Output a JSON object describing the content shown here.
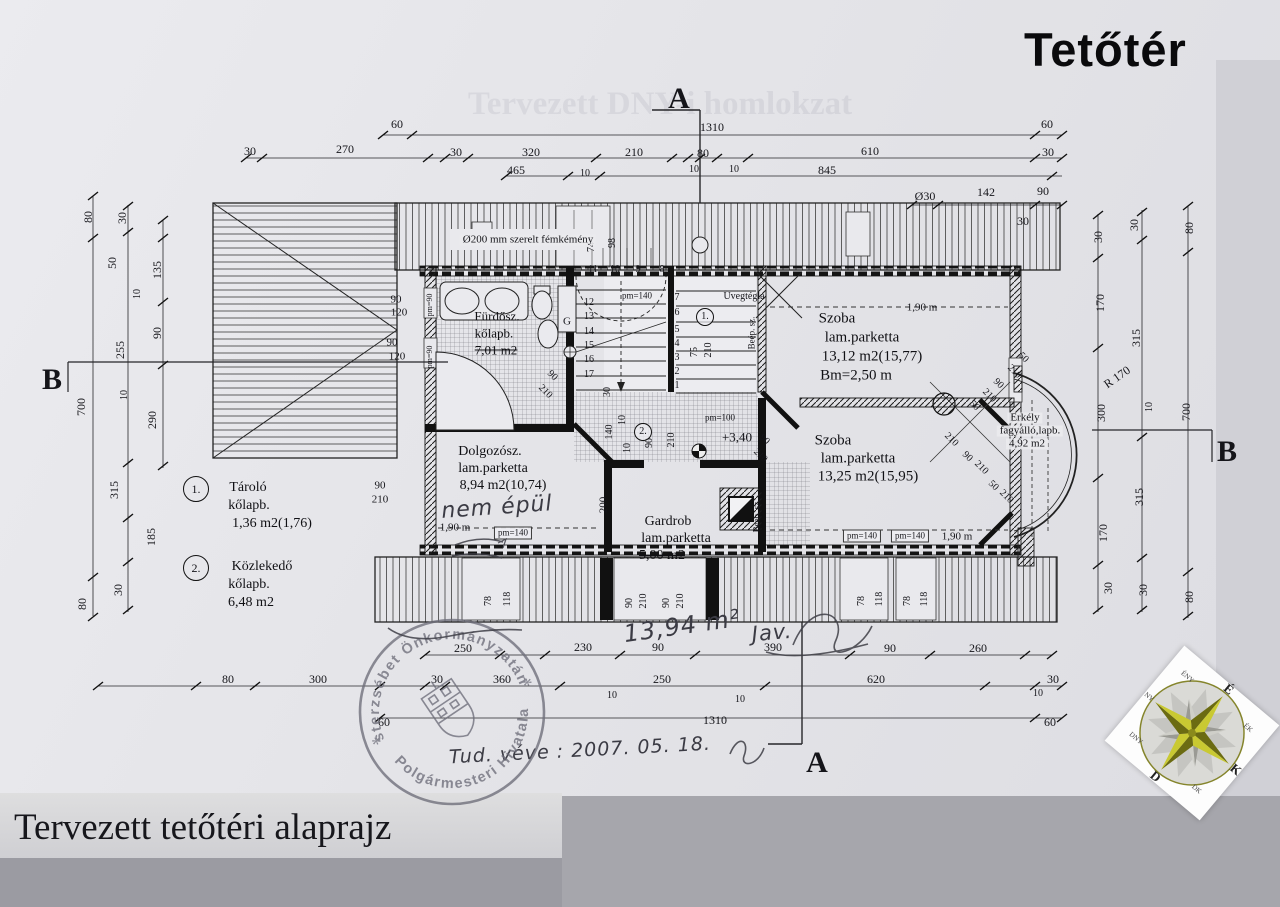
{
  "page": {
    "title": "Tetőtér",
    "caption": "Tervezett tetőtéri alaprajz",
    "ghost_text": "Tervezett DNY-i homlokzat"
  },
  "stamp": {
    "arc_top": "Pesterzsébet Önkormányzatának",
    "arc_bottom": "Polgármesteri Hivatala",
    "star": "*",
    "ink_color": "#6e6e7a"
  },
  "compass": {
    "points": [
      {
        "t": "É",
        "a": 0
      },
      {
        "t": "ÉK",
        "a": 45
      },
      {
        "t": "K",
        "a": 90
      },
      {
        "t": "DK",
        "a": 135
      },
      {
        "t": "D",
        "a": 180
      },
      {
        "t": "DNY",
        "a": 225
      },
      {
        "t": "NY",
        "a": 270
      },
      {
        "t": "ÉNY",
        "a": 315
      }
    ],
    "star_color": "#a8a81e"
  },
  "plan": {
    "labels": [
      {
        "t": "60",
        "x": 397,
        "y": 124
      },
      {
        "t": "1310",
        "x": 712,
        "y": 127
      },
      {
        "t": "60",
        "x": 1047,
        "y": 124
      },
      {
        "t": "30",
        "x": 250,
        "y": 151
      },
      {
        "t": "270",
        "x": 345,
        "y": 149
      },
      {
        "t": "30",
        "x": 456,
        "y": 152
      },
      {
        "t": "320",
        "x": 531,
        "y": 152
      },
      {
        "t": "210",
        "x": 634,
        "y": 152
      },
      {
        "t": "80",
        "x": 703,
        "y": 153
      },
      {
        "t": "610",
        "x": 870,
        "y": 151
      },
      {
        "t": "30",
        "x": 1048,
        "y": 152
      },
      {
        "t": "10",
        "x": 694,
        "y": 170,
        "s": 10
      },
      {
        "t": "10",
        "x": 734,
        "y": 170,
        "s": 10
      },
      {
        "t": "465",
        "x": 516,
        "y": 170
      },
      {
        "t": "10",
        "x": 585,
        "y": 174,
        "s": 10
      },
      {
        "t": "845",
        "x": 827,
        "y": 170
      },
      {
        "t": "Ø30",
        "x": 925,
        "y": 196
      },
      {
        "t": "142",
        "x": 986,
        "y": 192
      },
      {
        "t": "90",
        "x": 1043,
        "y": 191
      },
      {
        "t": "30",
        "x": 1023,
        "y": 221
      },
      {
        "t": "30",
        "x": 1098,
        "y": 237,
        "r": -90
      },
      {
        "t": "30",
        "x": 1134,
        "y": 225,
        "r": -90
      },
      {
        "t": "80",
        "x": 1189,
        "y": 228,
        "r": -90
      },
      {
        "t": "170",
        "x": 1100,
        "y": 303,
        "r": -90
      },
      {
        "t": "315",
        "x": 1136,
        "y": 338,
        "r": -90
      },
      {
        "t": "R 170",
        "x": 1117,
        "y": 377,
        "r": -35
      },
      {
        "t": "300",
        "x": 1101,
        "y": 413,
        "r": -90
      },
      {
        "t": "10",
        "x": 1150,
        "y": 407,
        "r": -90,
        "s": 10
      },
      {
        "t": "700",
        "x": 1186,
        "y": 412,
        "r": -90
      },
      {
        "t": "315",
        "x": 1139,
        "y": 497,
        "r": -90
      },
      {
        "t": "170",
        "x": 1103,
        "y": 533,
        "r": -90
      },
      {
        "t": "30",
        "x": 1108,
        "y": 588,
        "r": -90
      },
      {
        "t": "30",
        "x": 1143,
        "y": 590,
        "r": -90
      },
      {
        "t": "80",
        "x": 1189,
        "y": 597,
        "r": -90
      },
      {
        "t": "80",
        "x": 88,
        "y": 217,
        "r": -90
      },
      {
        "t": "30",
        "x": 122,
        "y": 218,
        "r": -90
      },
      {
        "t": "50",
        "x": 112,
        "y": 263,
        "r": -90
      },
      {
        "t": "135",
        "x": 157,
        "y": 270,
        "r": -90
      },
      {
        "t": "10",
        "x": 138,
        "y": 294,
        "r": -90,
        "s": 10
      },
      {
        "t": "90",
        "x": 157,
        "y": 333,
        "r": -90
      },
      {
        "t": "255",
        "x": 120,
        "y": 350,
        "r": -90
      },
      {
        "t": "700",
        "x": 81,
        "y": 407,
        "r": -90
      },
      {
        "t": "10",
        "x": 125,
        "y": 395,
        "r": -90,
        "s": 10
      },
      {
        "t": "290",
        "x": 152,
        "y": 420,
        "r": -90
      },
      {
        "t": "315",
        "x": 114,
        "y": 490,
        "r": -90
      },
      {
        "t": "185",
        "x": 151,
        "y": 537,
        "r": -90
      },
      {
        "t": "30",
        "x": 118,
        "y": 590,
        "r": -90
      },
      {
        "t": "80",
        "x": 82,
        "y": 604,
        "r": -90
      },
      {
        "t": "250",
        "x": 463,
        "y": 648
      },
      {
        "t": "230",
        "x": 583,
        "y": 647
      },
      {
        "t": "90",
        "x": 658,
        "y": 647
      },
      {
        "t": "390",
        "x": 773,
        "y": 647
      },
      {
        "t": "90",
        "x": 890,
        "y": 648
      },
      {
        "t": "260",
        "x": 978,
        "y": 648
      },
      {
        "t": "80",
        "x": 228,
        "y": 679
      },
      {
        "t": "300",
        "x": 318,
        "y": 679
      },
      {
        "t": "30",
        "x": 437,
        "y": 679
      },
      {
        "t": "360",
        "x": 502,
        "y": 679
      },
      {
        "t": "10",
        "x": 612,
        "y": 696,
        "s": 10
      },
      {
        "t": "250",
        "x": 662,
        "y": 679
      },
      {
        "t": "620",
        "x": 876,
        "y": 679
      },
      {
        "t": "30",
        "x": 1053,
        "y": 679
      },
      {
        "t": "10",
        "x": 1038,
        "y": 694,
        "s": 10
      },
      {
        "t": "10",
        "x": 740,
        "y": 700,
        "s": 10
      },
      {
        "t": "1310",
        "x": 715,
        "y": 720
      },
      {
        "t": "60",
        "x": 1050,
        "y": 722
      },
      {
        "t": "60",
        "x": 384,
        "y": 722
      },
      {
        "t": "78",
        "x": 489,
        "y": 601,
        "r": -90,
        "s": 10
      },
      {
        "t": "118",
        "x": 508,
        "y": 599,
        "r": -90,
        "s": 10
      },
      {
        "t": "90",
        "x": 630,
        "y": 603,
        "r": -90,
        "s": 10
      },
      {
        "t": "210",
        "x": 644,
        "y": 601,
        "r": -90,
        "s": 10
      },
      {
        "t": "90",
        "x": 667,
        "y": 603,
        "r": -90,
        "s": 10
      },
      {
        "t": "210",
        "x": 681,
        "y": 601,
        "r": -90,
        "s": 10
      },
      {
        "t": "78",
        "x": 862,
        "y": 601,
        "r": -90,
        "s": 10
      },
      {
        "t": "118",
        "x": 880,
        "y": 599,
        "r": -90,
        "s": 10
      },
      {
        "t": "78",
        "x": 908,
        "y": 601,
        "r": -90,
        "s": 10
      },
      {
        "t": "118",
        "x": 925,
        "y": 599,
        "r": -90,
        "s": 10
      },
      {
        "t": "74",
        "x": 592,
        "y": 247,
        "r": -90,
        "s": 10
      },
      {
        "t": "98",
        "x": 613,
        "y": 243,
        "r": -90,
        "s": 10
      },
      {
        "t": "75",
        "x": 695,
        "y": 352,
        "r": -90,
        "s": 10
      },
      {
        "t": "210",
        "x": 709,
        "y": 350,
        "r": -90,
        "s": 10
      },
      {
        "t": "90",
        "x": 396,
        "y": 300,
        "s": 11
      },
      {
        "t": "120",
        "x": 399,
        "y": 313,
        "s": 11
      },
      {
        "t": "90",
        "x": 392,
        "y": 343,
        "s": 11
      },
      {
        "t": "120",
        "x": 397,
        "y": 357,
        "s": 11
      },
      {
        "t": "pm=90",
        "x": 430,
        "y": 305,
        "r": -90,
        "s": 8
      },
      {
        "t": "pm=90",
        "x": 430,
        "y": 357,
        "r": -90,
        "s": 8
      },
      {
        "t": "90",
        "x": 380,
        "y": 486,
        "s": 11
      },
      {
        "t": "210",
        "x": 380,
        "y": 500,
        "s": 11
      },
      {
        "t": "90",
        "x": 552,
        "y": 376,
        "r": 45,
        "s": 10
      },
      {
        "t": "210",
        "x": 545,
        "y": 392,
        "r": 45,
        "s": 10
      },
      {
        "t": "50",
        "x": 1023,
        "y": 358,
        "r": 45,
        "s": 10
      },
      {
        "t": "210",
        "x": 1014,
        "y": 372,
        "r": 45,
        "s": 10
      },
      {
        "t": "90",
        "x": 998,
        "y": 384,
        "r": 45,
        "s": 10
      },
      {
        "t": "210",
        "x": 989,
        "y": 396,
        "r": 45,
        "s": 10
      },
      {
        "t": "50",
        "x": 974,
        "y": 406,
        "r": 45,
        "s": 10
      },
      {
        "t": "210",
        "x": 951,
        "y": 440,
        "r": 45,
        "s": 10
      },
      {
        "t": "90",
        "x": 967,
        "y": 457,
        "r": 45,
        "s": 10
      },
      {
        "t": "210",
        "x": 981,
        "y": 468,
        "r": 45,
        "s": 10
      },
      {
        "t": "50",
        "x": 993,
        "y": 486,
        "r": 45,
        "s": 10
      },
      {
        "t": "210",
        "x": 1006,
        "y": 497,
        "r": 45,
        "s": 10
      },
      {
        "t": "90",
        "x": 764,
        "y": 440,
        "r": 45,
        "s": 10
      },
      {
        "t": "210",
        "x": 760,
        "y": 456,
        "r": 45,
        "s": 10
      },
      {
        "t": "12",
        "x": 589,
        "y": 303,
        "s": 10
      },
      {
        "t": "13",
        "x": 589,
        "y": 317,
        "s": 10
      },
      {
        "t": "14",
        "x": 589,
        "y": 332,
        "s": 10
      },
      {
        "t": "15",
        "x": 589,
        "y": 346,
        "s": 10
      },
      {
        "t": "16",
        "x": 589,
        "y": 360,
        "s": 10
      },
      {
        "t": "17",
        "x": 589,
        "y": 375,
        "s": 10
      },
      {
        "t": "7",
        "x": 677,
        "y": 298,
        "s": 10
      },
      {
        "t": "6",
        "x": 677,
        "y": 313,
        "s": 10
      },
      {
        "t": "5",
        "x": 677,
        "y": 330,
        "s": 10
      },
      {
        "t": "4",
        "x": 677,
        "y": 344,
        "s": 10
      },
      {
        "t": "3",
        "x": 677,
        "y": 358,
        "s": 10
      },
      {
        "t": "2",
        "x": 677,
        "y": 372,
        "s": 10
      },
      {
        "t": "1",
        "x": 677,
        "y": 386,
        "s": 10
      },
      {
        "t": "11",
        "x": 593,
        "y": 270,
        "s": 10
      },
      {
        "t": "10",
        "x": 615,
        "y": 270,
        "s": 10
      },
      {
        "t": "9",
        "x": 638,
        "y": 270,
        "s": 10
      },
      {
        "t": "8",
        "x": 662,
        "y": 270,
        "s": 10
      },
      {
        "t": "Ø200 mm szerelt fémkémény",
        "x": 528,
        "y": 240,
        "s": 11,
        "c": "wbg",
        "n": "chimney-note"
      },
      {
        "t": "pm=140",
        "x": 637,
        "y": 296,
        "s": 9
      },
      {
        "t": "Üvegtégla",
        "x": 744,
        "y": 297,
        "s": 10,
        "n": "glass-brick-note"
      },
      {
        "t": "Beép. sz.",
        "x": 752,
        "y": 333,
        "r": -90,
        "s": 9
      },
      {
        "t": "Beép. sz.",
        "x": 757,
        "y": 516,
        "r": -90,
        "s": 9
      },
      {
        "t": "pm=100",
        "x": 720,
        "y": 418,
        "s": 9
      },
      {
        "t": "+3,40",
        "x": 737,
        "y": 437,
        "s": 13,
        "n": "level-mark"
      },
      {
        "t": "G",
        "x": 567,
        "y": 322,
        "s": 11
      },
      {
        "t": "1,90 m",
        "x": 922,
        "y": 308,
        "s": 11
      },
      {
        "t": "1,90 m",
        "x": 455,
        "y": 528,
        "s": 11
      },
      {
        "t": "1,90 m",
        "x": 957,
        "y": 537,
        "s": 11
      },
      {
        "t": "pm=140",
        "x": 513,
        "y": 533,
        "s": 9,
        "c": "box"
      },
      {
        "t": "pm=140",
        "x": 862,
        "y": 536,
        "s": 9,
        "c": "box"
      },
      {
        "t": "pm=140",
        "x": 910,
        "y": 536,
        "s": 9,
        "c": "box"
      },
      {
        "t": "200",
        "x": 604,
        "y": 505,
        "r": -90,
        "s": 11
      },
      {
        "t": "140",
        "x": 610,
        "y": 432,
        "r": -90,
        "s": 10
      },
      {
        "t": "10",
        "x": 628,
        "y": 448,
        "r": -90,
        "s": 10
      },
      {
        "t": "90",
        "x": 650,
        "y": 443,
        "r": -90,
        "s": 10
      },
      {
        "t": "210",
        "x": 672,
        "y": 440,
        "r": -90,
        "s": 10
      },
      {
        "t": "30",
        "x": 608,
        "y": 392,
        "r": -90,
        "s": 10
      },
      {
        "t": "10",
        "x": 623,
        "y": 420,
        "r": -90,
        "s": 10
      },
      {
        "t": "1.",
        "x": 705,
        "y": 317,
        "s": 10,
        "c": "circ"
      },
      {
        "t": "2.",
        "x": 643,
        "y": 432,
        "s": 10,
        "c": "circ"
      },
      {
        "t": "Fürdősz.",
        "x": 497,
        "y": 316,
        "s": 13,
        "c": "room",
        "n": "room-label-furdoszoba"
      },
      {
        "t": "kőlapb.",
        "x": 494,
        "y": 333,
        "s": 13,
        "c": "room"
      },
      {
        "t": "7,01 m2",
        "x": 496,
        "y": 350,
        "s": 13,
        "c": "room struck"
      },
      {
        "t": "Szoba",
        "x": 837,
        "y": 319,
        "s": 15,
        "c": "room",
        "n": "room-label-szoba-1"
      },
      {
        "t": "lam.parketta",
        "x": 862,
        "y": 338,
        "s": 15,
        "c": "room"
      },
      {
        "t": "13,12 m2(15,77)",
        "x": 872,
        "y": 357,
        "s": 15,
        "c": "room"
      },
      {
        "t": "Bm=2,50 m",
        "x": 856,
        "y": 376,
        "s": 15,
        "c": "room"
      },
      {
        "t": "Szoba",
        "x": 833,
        "y": 441,
        "s": 15,
        "c": "room",
        "n": "room-label-szoba-2"
      },
      {
        "t": "lam.parketta",
        "x": 858,
        "y": 459,
        "s": 15,
        "c": "room"
      },
      {
        "t": "13,25 m2(15,95)",
        "x": 868,
        "y": 477,
        "s": 15,
        "c": "room"
      },
      {
        "t": "Erkély",
        "x": 1025,
        "y": 418,
        "s": 11,
        "c": "room wbg",
        "n": "room-label-erkely"
      },
      {
        "t": "fagyálló,lapb.",
        "x": 1030,
        "y": 431,
        "s": 11,
        "c": "room wbg"
      },
      {
        "t": "4,92 m2",
        "x": 1027,
        "y": 444,
        "s": 11,
        "c": "room wbg"
      },
      {
        "t": "Dolgozósz.",
        "x": 490,
        "y": 452,
        "s": 14,
        "c": "room",
        "n": "room-label-dolgozoszoba"
      },
      {
        "t": "lam.parketta",
        "x": 493,
        "y": 469,
        "s": 14,
        "c": "room"
      },
      {
        "t": "8,94 m2(10,74)",
        "x": 503,
        "y": 486,
        "s": 14,
        "c": "room"
      },
      {
        "t": "Gardrob",
        "x": 668,
        "y": 522,
        "s": 14,
        "c": "room",
        "n": "room-label-gardrob"
      },
      {
        "t": "lam.parketta",
        "x": 676,
        "y": 539,
        "s": 14,
        "c": "room"
      },
      {
        "t": "5,00 m2",
        "x": 662,
        "y": 556,
        "s": 14,
        "c": "room struck"
      },
      {
        "t": "1.",
        "x": 196,
        "y": 489,
        "s": 12,
        "c": "circ2",
        "n": "legend-num-1"
      },
      {
        "t": "Tároló",
        "x": 248,
        "y": 488,
        "s": 14,
        "c": "room",
        "n": "legend-label-tarolo"
      },
      {
        "t": "kőlapb.",
        "x": 249,
        "y": 506,
        "s": 14,
        "c": "room"
      },
      {
        "t": "1,36 m2(1,76)",
        "x": 272,
        "y": 524,
        "s": 14,
        "c": "room"
      },
      {
        "t": "2.",
        "x": 196,
        "y": 568,
        "s": 12,
        "c": "circ2",
        "n": "legend-num-2"
      },
      {
        "t": "Közlekedő",
        "x": 262,
        "y": 567,
        "s": 14,
        "c": "room",
        "n": "legend-label-kozlekedo"
      },
      {
        "t": "kőlapb.",
        "x": 249,
        "y": 585,
        "s": 14,
        "c": "room"
      },
      {
        "t": "6,48 m2",
        "x": 251,
        "y": 603,
        "s": 14,
        "c": "room"
      },
      {
        "t": "A",
        "x": 679,
        "y": 99,
        "s": 30,
        "c": "mk",
        "n": "section-marker-a-top"
      },
      {
        "t": "A",
        "x": 817,
        "y": 763,
        "s": 30,
        "c": "mk",
        "n": "section-marker-a-bottom"
      },
      {
        "t": "B",
        "x": 52,
        "y": 380,
        "s": 30,
        "c": "mk",
        "n": "section-marker-b-left"
      },
      {
        "t": "B",
        "x": 1227,
        "y": 452,
        "s": 30,
        "c": "mk",
        "n": "section-marker-b-right"
      },
      {
        "t": "nem épül",
        "x": 497,
        "y": 508,
        "s": 22,
        "r": -4,
        "c": "hw",
        "n": "handwritten-note"
      },
      {
        "t": "13,94 m²",
        "x": 682,
        "y": 626,
        "s": 24,
        "r": -8,
        "c": "hw",
        "n": "handwritten-area"
      },
      {
        "t": "Jav.",
        "x": 772,
        "y": 633,
        "s": 21,
        "r": -5,
        "c": "hw",
        "n": "handwritten-signature"
      },
      {
        "t": "Tud. véve : 2007. 05. 18.",
        "x": 580,
        "y": 751,
        "s": 19,
        "r": -3,
        "c": "hw",
        "n": "handwritten-date"
      }
    ]
  }
}
